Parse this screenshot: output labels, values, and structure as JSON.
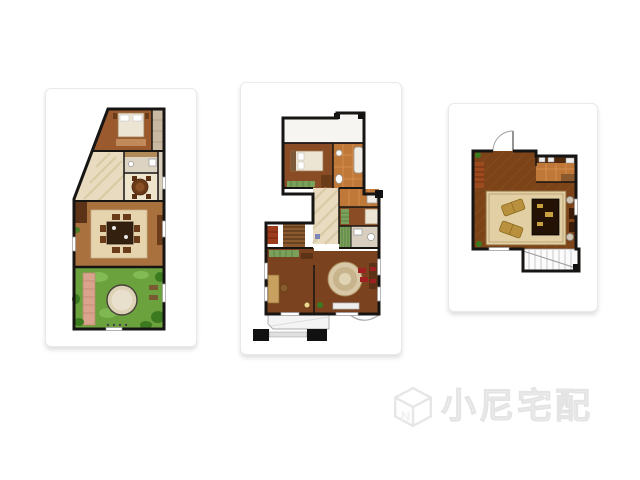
{
  "watermark": {
    "text": "小尼宅配",
    "logo_letter": "N"
  },
  "palette": {
    "wall": "#171513",
    "cardBorder": "#ebe9e6",
    "watermarkColor": "#f2f2f2",
    "wmStroke": "#e6e6e6",
    "wood1": "#9a5a2e",
    "wood2": "#a8713d",
    "wood3": "#8a4c24",
    "wood4": "#7a421e",
    "wood5": "#7c4318",
    "herr": "#8f5526",
    "tile": "#c07838",
    "tileGrid": "#d89252",
    "beige": "#e8dbbf",
    "beigeDark": "#efe4cc",
    "rug": "#e5d4ae",
    "rug2": "#e2cfa4",
    "lawn": "#6ca23e",
    "lawnLight": "#8cc45e",
    "bush": "#3c7a20",
    "stone": "#d9a38d",
    "bedWhite": "#ece5d4",
    "tableDark": "#34200f",
    "sofa": "#b8903e",
    "greenRug": "#7aa05a",
    "redCabinet": "#9c3c1c",
    "stairsWood": "#8a5a2e",
    "grayLine": "#999999"
  }
}
